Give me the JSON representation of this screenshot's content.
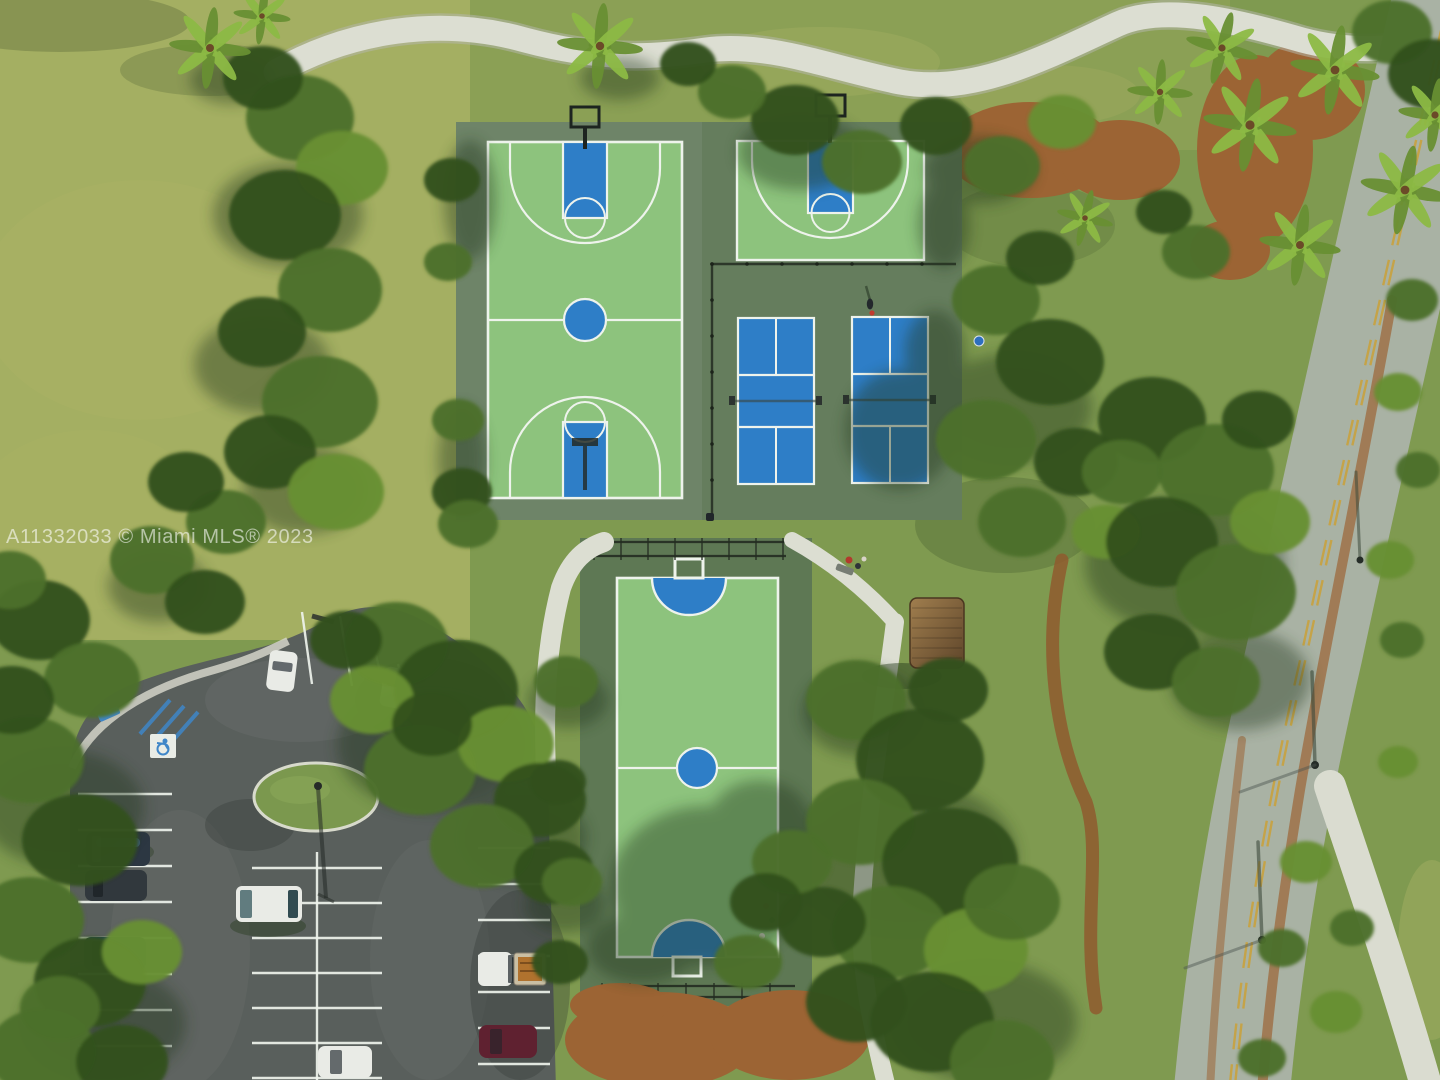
{
  "image": {
    "kind": "aerial-drone-photograph",
    "alt": "Aerial view of a community park with basketball, pickleball and futsal courts, walking paths, a tree-lined road and a parking lot"
  },
  "watermark": {
    "text": "A11332033 © Miami MLS® 2023"
  },
  "features": {
    "grass_field": "Open grass field",
    "walking_path": "Concrete walking path",
    "basketball_full_court": "Full basketball court",
    "basketball_half_court": "Half basketball court",
    "pickleball_courts": "Two pickleball courts",
    "futsal_court": "Futsal court with goals",
    "parking_lot": "Parking lot with painted stalls",
    "parking_island": "Landscaped island with light pole",
    "accessible_parking": "Accessible parking markings",
    "parked_cars": "Parked cars",
    "road": "Road with double yellow centerline",
    "sidewalk": "Curved sidewalk",
    "shade_hut": "Wooden shade hut",
    "tree_canopy": "Tree canopy",
    "palm_trees": "Palm trees",
    "mulch_beds": "Mulch planting beds",
    "person": "Person standing by pickleball court"
  },
  "colors": {
    "field_grass": "#a9b164",
    "grass": "#7f9a50",
    "grass_dark": "#62813f",
    "shade": "#24371a",
    "canopy_dark": "#33511f",
    "canopy_mid": "#4c7029",
    "canopy_light": "#688f33",
    "canopy_bright": "#82aa3e",
    "palm": "#8cb944",
    "apron": "#6e8468",
    "apron_dark": "#5e7854",
    "court_green": "#8dc37d",
    "court_blue": "#2e7ec7",
    "line_white": "#eef3ec",
    "concrete": "#dcded2",
    "road": "#a9b2a4",
    "road_yellow": "#c9a23f",
    "asphalt": "#595f5c",
    "mulch": "#9c6434",
    "sidewalk": "#dadcd0",
    "trunk": "#6b4a28",
    "car_white": "#e9ebe6",
    "handicap_blue": "#3f86c8"
  }
}
